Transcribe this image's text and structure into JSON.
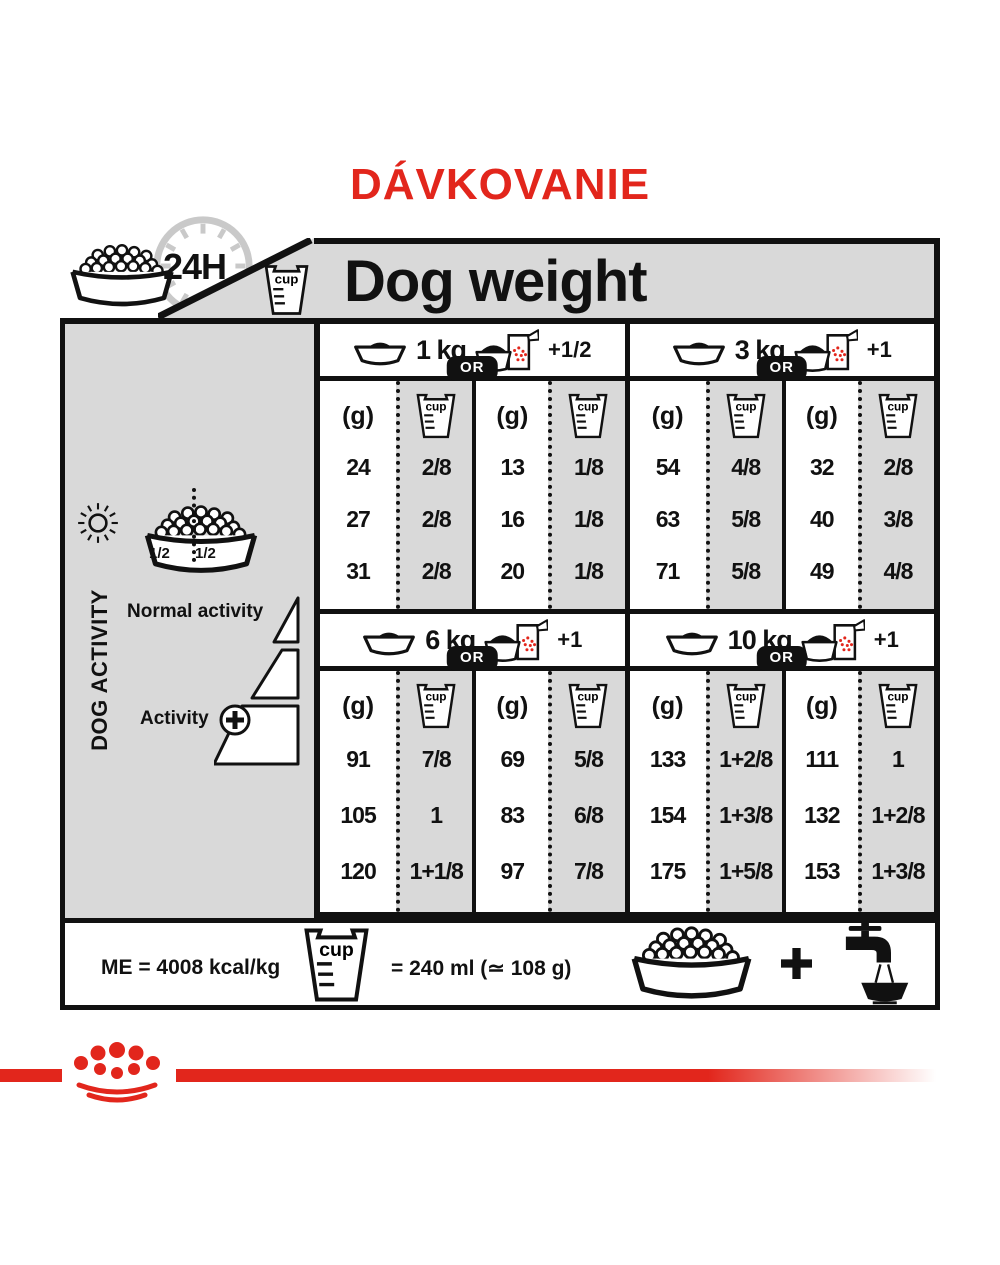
{
  "page": {
    "title": "DÁVKOVANIE"
  },
  "header": {
    "dog_weight": "Dog weight",
    "daily_ration": "24H"
  },
  "labels": {
    "cup": "cup",
    "or": "OR",
    "grams": "(g)"
  },
  "sidebar": {
    "title": "DOG ACTIVITY",
    "half_left": "1/2",
    "half_right": "1/2",
    "normal_activity": "Normal activity",
    "activity": "Activity"
  },
  "table": {
    "sections": [
      {
        "weight": "1 kg",
        "extra": "+1/2",
        "dry": {
          "g": [
            "24",
            "27",
            "31"
          ],
          "cup": [
            "2/8",
            "2/8",
            "2/8"
          ]
        },
        "mixed": {
          "g": [
            "13",
            "16",
            "20"
          ],
          "cup": [
            "1/8",
            "1/8",
            "1/8"
          ]
        }
      },
      {
        "weight": "3 kg",
        "extra": "+1",
        "dry": {
          "g": [
            "54",
            "63",
            "71"
          ],
          "cup": [
            "4/8",
            "5/8",
            "5/8"
          ]
        },
        "mixed": {
          "g": [
            "32",
            "40",
            "49"
          ],
          "cup": [
            "2/8",
            "3/8",
            "4/8"
          ]
        }
      },
      {
        "weight": "6 kg",
        "extra": "+1",
        "dry": {
          "g": [
            "91",
            "105",
            "120"
          ],
          "cup": [
            "7/8",
            "1",
            "1+1/8"
          ]
        },
        "mixed": {
          "g": [
            "69",
            "83",
            "97"
          ],
          "cup": [
            "5/8",
            "6/8",
            "7/8"
          ]
        }
      },
      {
        "weight": "10 kg",
        "extra": "+1",
        "dry": {
          "g": [
            "133",
            "154",
            "175"
          ],
          "cup": [
            "1+2/8",
            "1+3/8",
            "1+5/8"
          ]
        },
        "mixed": {
          "g": [
            "111",
            "132",
            "153"
          ],
          "cup": [
            "1",
            "1+2/8",
            "1+3/8"
          ]
        }
      }
    ]
  },
  "footer": {
    "energy": "ME = 4008 kcal/kg",
    "cup_equivalence": "= 240 ml (≃ 108 g)"
  },
  "icons": [
    "kibble-bowl",
    "24h-clock",
    "measuring-cup",
    "sun",
    "moon",
    "bowl-plus-pouch",
    "water-tap",
    "plus",
    "crown-logo"
  ],
  "colors": {
    "red": "#e2261c",
    "gray": "#d9d9d9",
    "black": "#111111"
  }
}
